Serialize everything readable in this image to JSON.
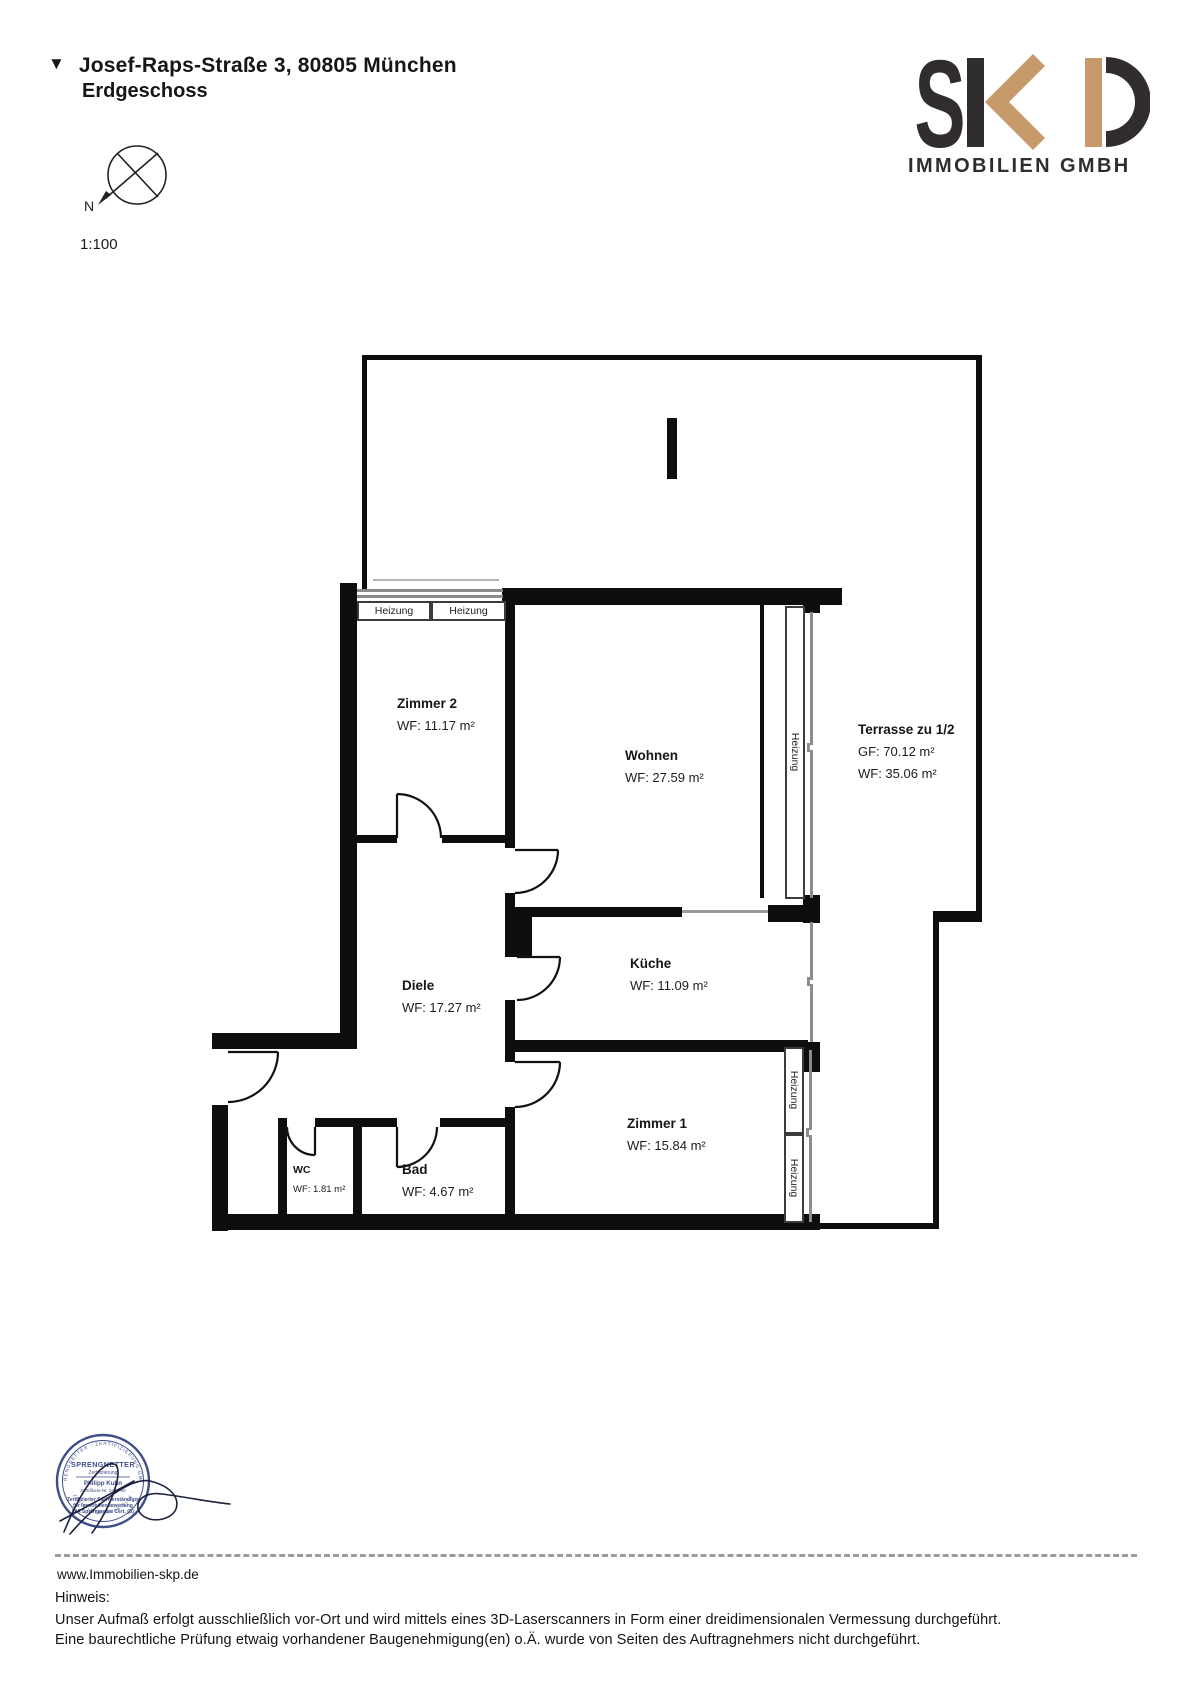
{
  "header": {
    "marker": "▼",
    "address": "Josef-Raps-Straße 3, 80805 München",
    "floor": "Erdgeschoss",
    "scale": "1:100",
    "compass_north": "N"
  },
  "logo": {
    "letter_s": "S",
    "company": "IMMOBILIEN GMBH",
    "color_dark": "#312d2f",
    "color_tan": "#c79a6b"
  },
  "plan": {
    "heizung_label": "Heizung",
    "rooms": [
      {
        "id": "zimmer2",
        "name": "Zimmer 2",
        "line1": "WF: 11.17 m²"
      },
      {
        "id": "wohnen",
        "name": "Wohnen",
        "line1": "WF: 27.59 m²"
      },
      {
        "id": "terrasse",
        "name": "Terrasse zu 1/2",
        "line1": "GF: 70.12 m²",
        "line2": "WF: 35.06 m²"
      },
      {
        "id": "diele",
        "name": "Diele",
        "line1": "WF: 17.27 m²"
      },
      {
        "id": "kueche",
        "name": "Küche",
        "line1": "WF: 11.09 m²"
      },
      {
        "id": "zimmer1",
        "name": "Zimmer 1",
        "line1": "WF: 15.84 m²"
      },
      {
        "id": "wc",
        "name": "WC",
        "line1": "WF: 1.81 m²"
      },
      {
        "id": "bad",
        "name": "Bad",
        "line1": "WF: 4.67 m²"
      }
    ]
  },
  "stamp": {
    "ring_text_top": "SPRENGNETTER · ZERTIFIZIERUNG GMBH",
    "ring_text_bottom": "· ZERTIFIZIERUNGSSTELLE ·",
    "brand": "SPRENGNETTER",
    "brand_sub": "Zertifizierung",
    "name": "Philipp Kuhn",
    "cert_no": "Zertifikats-Nr. 2303-60",
    "line1": "Zertifizierter Sachverständiger",
    "line2": "für Immobilienbewertung",
    "line3": "DIA Sprengnetter Cert. (S)",
    "color": "#2b3a7d"
  },
  "footer": {
    "url": "www.Immobilien-skp.de",
    "hinweis_label": "Hinweis:",
    "note1": "Unser Aufmaß erfolgt ausschließlich vor-Ort und wird mittels eines 3D-Laserscanners in Form einer dreidimensionalen Vermessung durchgeführt.",
    "note2": "Eine baurechtliche Prüfung etwaig vorhandener Baugenehmigung(en) o.Ä. wurde von Seiten des Auftragnehmers nicht durchgeführt."
  }
}
